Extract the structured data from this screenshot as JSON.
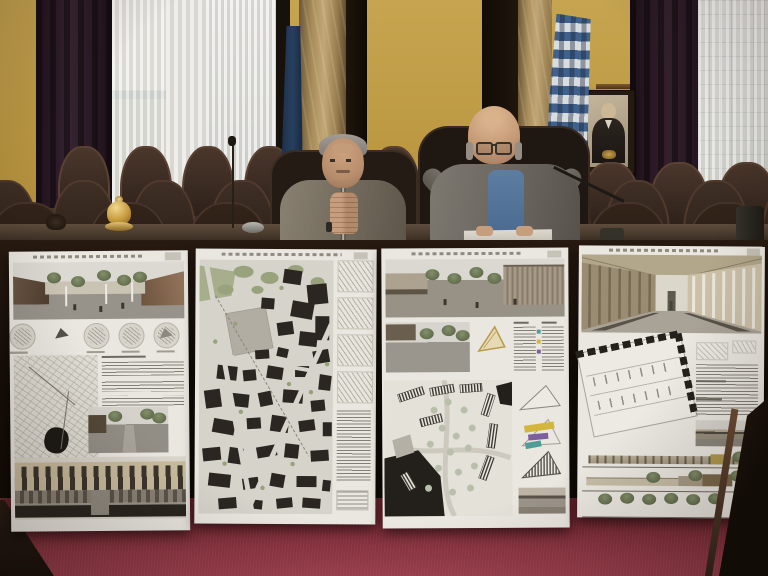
{
  "scene": {
    "setting": "city council chamber",
    "emblem_text": "ΙΩΑΝΝΙΝΑ",
    "people": [
      {
        "position": "left",
        "description": "grey-haired official in beige tweed jacket, hands clasped in front of face"
      },
      {
        "position": "right",
        "description": "bald official with glasses, grey jacket over blue shirt, reading papers at microphone"
      }
    ],
    "boards": [
      {
        "index": 1,
        "content": "plaza rendering, five concept circles, sketch plan, description text, street rendering, colonnade elevation"
      },
      {
        "index": 2,
        "content": "black-and-white figure-ground urban plan with green park areas and column of axonometric sketches"
      },
      {
        "index": 3,
        "content": "plaza rendering, site plan with hatched building bars, stacked triangular massing diagrams with colored elements"
      },
      {
        "index": 4,
        "content": "interior market-hall perspective, tilted floor plan, description text, small rendering, three elevation strips"
      }
    ],
    "flags": [
      {
        "name": "greek-flag",
        "colors": [
          "#41628e",
          "#d8dde2"
        ]
      },
      {
        "name": "dark-blue-flag",
        "colors": [
          "#223752"
        ]
      }
    ],
    "palette": {
      "wall_yellow": "#c09d46",
      "curtain_maroon": "#2c1a25",
      "window_sheer": "#e6e4df",
      "marble_column": "#b2975f",
      "gold_frame": "#bd9c3e",
      "chair_brown": "#38291f",
      "desk_wood": "#20150d",
      "board_white": "#eae7e0",
      "carpet_red": "#943b48"
    }
  }
}
